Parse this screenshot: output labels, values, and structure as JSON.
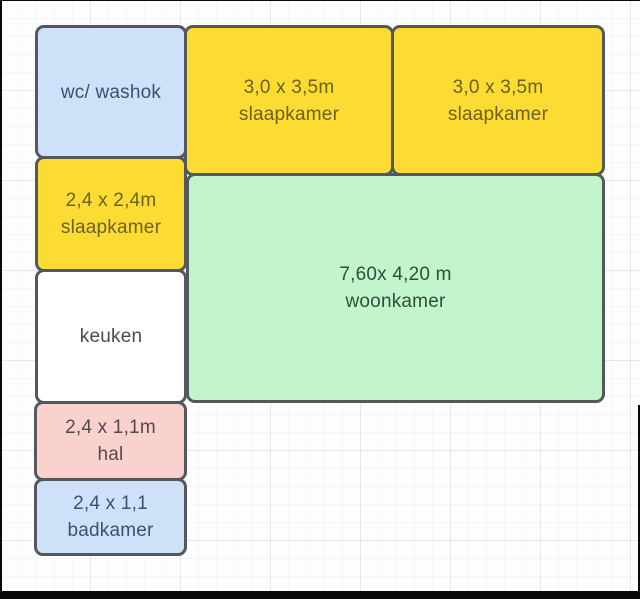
{
  "diagram": {
    "type": "floor-plan",
    "canvas_background": "#fdfdfd",
    "grid_color": "#e8eaec",
    "shape_border_color": "#53585c",
    "frame_color": "#0a0a0a"
  },
  "rooms": [
    {
      "name": "wc-washok",
      "line1": "wc/ washok",
      "line2": "",
      "fill": "#cfe1f8",
      "text_color": "#3e5070"
    },
    {
      "name": "slaapkamer-top-left",
      "line1": "3,0 x 3,5m",
      "line2": "slaapkamer",
      "fill": "#fcdc33",
      "text_color": "#6a6124"
    },
    {
      "name": "slaapkamer-top-right",
      "line1": "3,0 x 3,5m",
      "line2": "slaapkamer",
      "fill": "#fcdc33",
      "text_color": "#6a6124"
    },
    {
      "name": "slaapkamer-small",
      "line1": "2,4 x 2,4m",
      "line2": "slaapkamer",
      "fill": "#fcdc33",
      "text_color": "#6a6124"
    },
    {
      "name": "woonkamer",
      "line1": "7,60x 4,20 m",
      "line2": "woonkamer",
      "fill": "#c2f5cb",
      "text_color": "#2f4f3c"
    },
    {
      "name": "keuken",
      "line1": "keuken",
      "line2": "",
      "fill": "#ffffff",
      "text_color": "#474d52"
    },
    {
      "name": "hal",
      "line1": "2,4 x 1,1m",
      "line2": "hal",
      "fill": "#f9d2ce",
      "text_color": "#55494e"
    },
    {
      "name": "badkamer",
      "line1": "2,4 x 1,1",
      "line2": "badkamer",
      "fill": "#cfe1f8",
      "text_color": "#3e5070"
    }
  ]
}
